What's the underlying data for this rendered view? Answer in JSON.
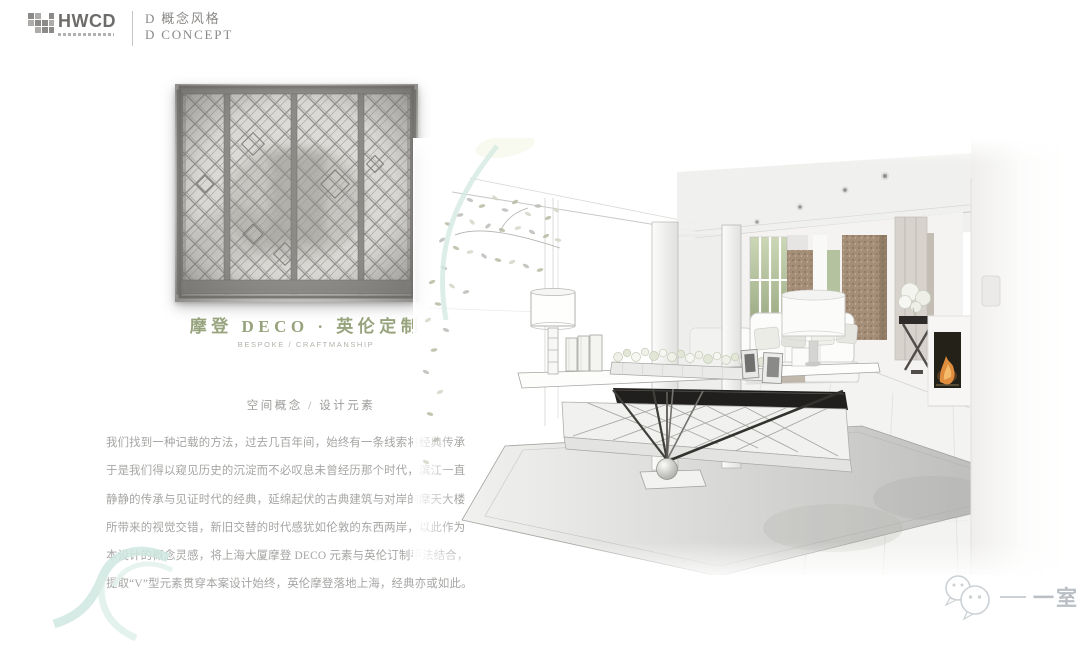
{
  "header": {
    "logo_text": "HWCD",
    "section_title_cn": "D 概念风格",
    "section_title_en": "D CONCEPT"
  },
  "concept": {
    "title": "摩登 DECO · 英伦定制",
    "subtitle": "BESPOKE / CRAFTMANSHIP",
    "caption": "空间概念 / 设计元素",
    "body_lines": [
      "我们找到一种记载的方法，过去几百年间，始终有一条线索将经典传承",
      "于是我们得以窥见历史的沉淀而不必叹息未曾经历那个时代，滨江一直",
      "静静的传承与见证时代的经典，延绵起伏的古典建筑与对岸的摩天大楼",
      "所带来的视觉交错，新旧交替的时代感犹如伦敦的东西两岸，以此作为",
      "本设计的概念灵感，将上海大厦摩登 DECO 元素与英伦订制手法结合，",
      "提取“V”型元素贯穿本案设计始终，英伦摩登落地上海，经典亦或如此。"
    ]
  },
  "watermark": {
    "label": "一室"
  },
  "colors": {
    "title_olive": "#97a37d",
    "text_gray": "#a5a5a3",
    "header_gray": "#8a8886",
    "watermark_gray": "#b9bfc5",
    "accent_teal": "#cfe8e1",
    "flame_orange": "#e08d3e",
    "bronze": "#a58e77"
  }
}
